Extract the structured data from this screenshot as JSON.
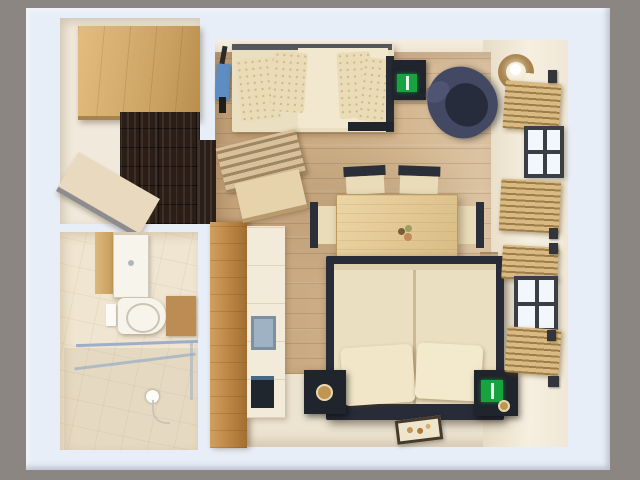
{
  "scene": {
    "kind": "3d-floorplan-render",
    "view": "top-down-dollhouse",
    "subject": "studio apartment floor plan",
    "visible_text": "none"
  },
  "palette": {
    "bg_grey": "#8b8681",
    "wall_outer": "#e8eef7",
    "wall_inner": "#f7f9fc",
    "hall_floor": "#f1e9dc",
    "hall_parquet": "#2b1e16",
    "wood_cabinet": "#d4a96b",
    "bath_floor": "#efe5d0",
    "porcelain": "#f7f4ec",
    "bath_mat": "#bb8d55",
    "glass_blue": "#93a9c6",
    "door_wood": "#c08a45",
    "kitchen_white": "#f3ebd9",
    "sink_blue": "#9fb2c4",
    "floor_wood": "#cbaa82",
    "floor_cream": "#ece3d0",
    "wall_beige": "#f0e8d6",
    "navy": "#272c38",
    "navy_light": "#434963",
    "linen": "#ebdfc1",
    "linen_light": "#f1e8cf",
    "green": "#17a33f",
    "gold": "#bf9551",
    "bamboo": "#d9ba82",
    "window_frame": "#3b3e44",
    "window_pane": "#f2f7fb",
    "blue_item": "#5d8dc2",
    "rattan": "#a5804b"
  },
  "rooms": [
    {
      "name": "entry-hall",
      "items": [
        "wardrobe",
        "dark-basketweave-parquet",
        "open-door",
        "doorway-to-main-room"
      ]
    },
    {
      "name": "bathroom",
      "items": [
        "vanity-sink",
        "wood-side-panel",
        "toilet",
        "toilet-paper-holder",
        "bath-mat",
        "glass-shower-partition",
        "shower-head-with-hose"
      ]
    },
    {
      "name": "kitchen-strip",
      "items": [
        "tall-wood-door-panel",
        "kitchenette-counter",
        "kitchen-sink",
        "oven"
      ]
    },
    {
      "name": "main-room",
      "items": [
        "ironing-board-blue",
        "sofa-bed-with-pillows",
        "mini-console",
        "green-console-lamp",
        "tub-armchair-navy",
        "rattan-floor-lamp",
        "coat-rack-slatted",
        "wall-shelf",
        "dining-table",
        "dining-chair-x4",
        "flower-centerpiece",
        "double-bed",
        "bed-pillow-x2",
        "nightstand-left",
        "alarm-clock-gold",
        "nightstand-right",
        "green-bedside-lamp",
        "floor-picture-mat",
        "radiator",
        "window-upper",
        "window-lower",
        "bamboo-shade-x4",
        "curtain-hook-x5"
      ]
    }
  ]
}
